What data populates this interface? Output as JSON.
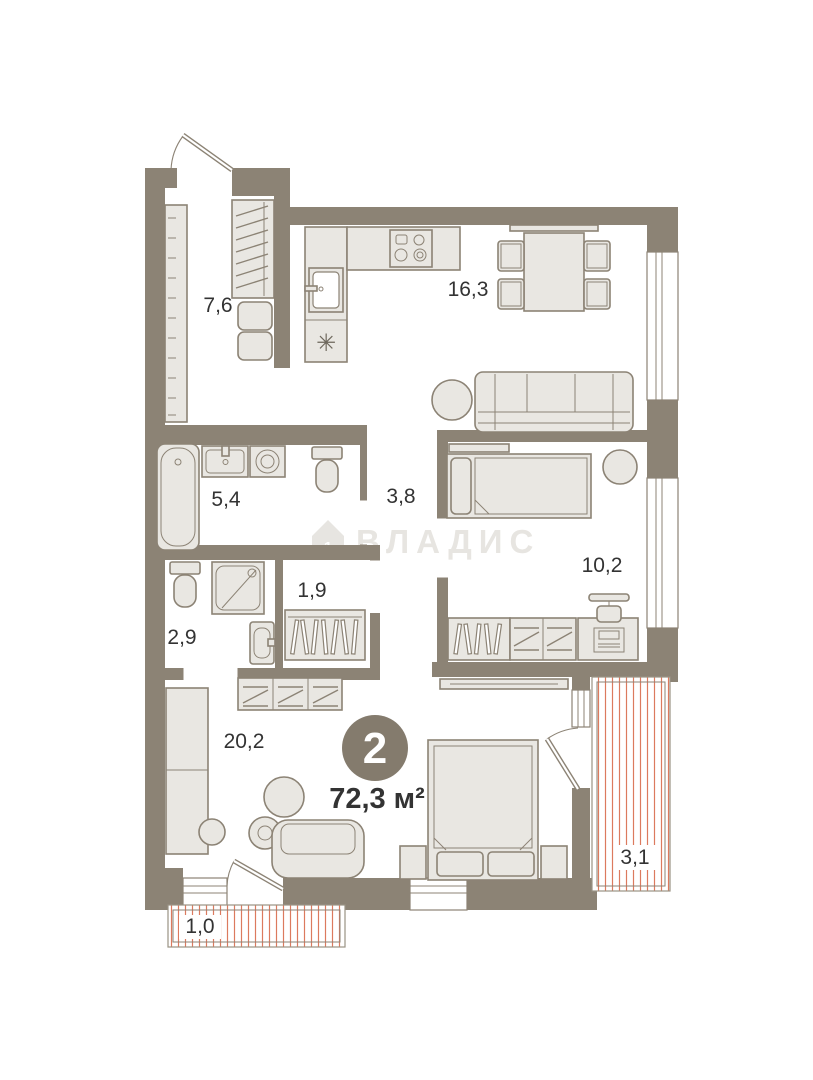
{
  "plan": {
    "title": "2-room apartment floor plan",
    "badge": {
      "rooms_count": "2",
      "total_area": "72,3 м²"
    },
    "watermark": {
      "brand": "ВЛАДИС",
      "icon_digit": "1"
    },
    "kitchen_appliance_mark": "✳",
    "rooms": [
      {
        "name": "entry-hall",
        "area": "7,6"
      },
      {
        "name": "kitchen-living-room",
        "area": "16,3"
      },
      {
        "name": "bathroom",
        "area": "5,4"
      },
      {
        "name": "corridor",
        "area": "3,8"
      },
      {
        "name": "wc-shower-room",
        "area": "2,9"
      },
      {
        "name": "walk-in-closet",
        "area": "1,9"
      },
      {
        "name": "bedroom",
        "area": "10,2"
      },
      {
        "name": "living-bedroom",
        "area": "20,2"
      },
      {
        "name": "loggia-right",
        "area": "3,1"
      },
      {
        "name": "loggia-bottom",
        "area": "1,0"
      }
    ],
    "colors": {
      "wall": "#8c8375",
      "furniture_fill": "#e9e7e2",
      "outline": "#8c8375",
      "loggia_hatch": "#dc7a5e",
      "badge_circle": "#847b6d",
      "label_text": "#333333",
      "watermark": "#e7e5e1",
      "background": "#ffffff"
    }
  }
}
